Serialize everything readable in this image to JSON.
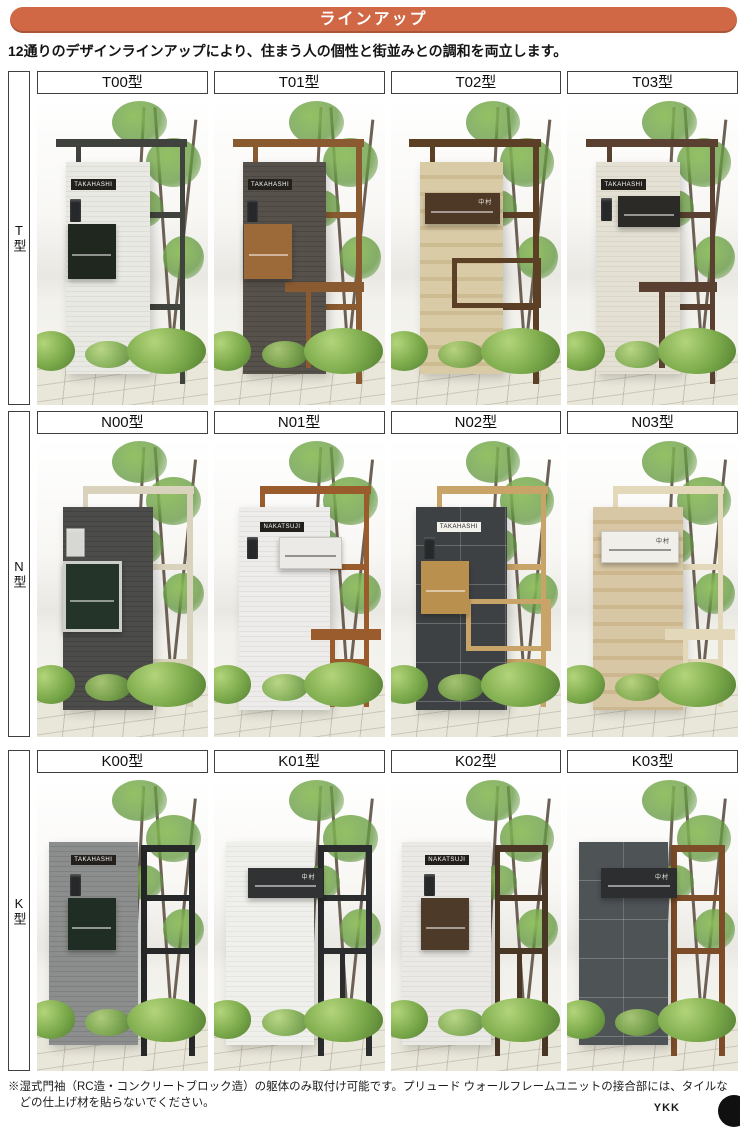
{
  "banner": {
    "label": "ラインアップ",
    "bg": "#d06845"
  },
  "intro": "12通りのデザインラインアップにより、住まう人の個性と街並みとの調和を両立します。",
  "rows": [
    {
      "side_label": "T型",
      "cells": [
        {
          "label": "T00型",
          "name": "TAKAHASHI",
          "colors": {
            "wall": "#e9e9e4",
            "wall2": "#dddcd5",
            "frame": "#3f423d",
            "mail": "#20271f"
          }
        },
        {
          "label": "T01型",
          "name": "TAKAHASHI",
          "colors": {
            "wall": "#57514b",
            "wall2": "#4b463f",
            "frame": "#8a5a31",
            "mail": "#9c6a38"
          }
        },
        {
          "label": "T02型",
          "name": "中村",
          "colors": {
            "wall": "#d9cba6",
            "wall2": "#cdbb92",
            "frame": "#5c4026",
            "mail": "#4e3826"
          }
        },
        {
          "label": "T03型",
          "name": "TAKAHASHI",
          "colors": {
            "wall": "#e4e1d4",
            "wall2": "#d9d6c7",
            "frame": "#5a4030",
            "mail": "#2c2a26"
          }
        }
      ]
    },
    {
      "side_label": "N型",
      "cells": [
        {
          "label": "N00型",
          "name": "",
          "colors": {
            "wall": "#4c4d4b",
            "wall2": "#424341",
            "frame": "#d9d3bd",
            "mail": "#243428"
          }
        },
        {
          "label": "N01型",
          "name": "NAKATSUJI",
          "colors": {
            "wall": "#edecea",
            "wall2": "#e1e0dd",
            "frame": "#9a5c2c",
            "mail": "#eceae6"
          }
        },
        {
          "label": "N02型",
          "name": "TAKAHASHI",
          "colors": {
            "wall": "#3e4143",
            "wall2": "#35383a",
            "frame": "#c9a469",
            "mail": "#b9904e"
          }
        },
        {
          "label": "N03型",
          "name": "中村",
          "colors": {
            "wall": "#d8c7a4",
            "wall2": "#ccb78e",
            "frame": "#e3d9ba",
            "mail": "#f0efe9"
          }
        }
      ]
    },
    {
      "side_label": "K型",
      "cells": [
        {
          "label": "K00型",
          "name": "TAKAHASHI",
          "colors": {
            "wall": "#8b8e8c",
            "wall2": "#7e817f",
            "frame": "#26282a",
            "mail": "#202d25"
          }
        },
        {
          "label": "K01型",
          "name": "中村",
          "colors": {
            "wall": "#efefeb",
            "wall2": "#e5e5e0",
            "frame": "#2a2c2e",
            "mail": "#303234"
          }
        },
        {
          "label": "K02型",
          "name": "NAKATSUJI",
          "colors": {
            "wall": "#eae9e5",
            "wall2": "#dfdeda",
            "frame": "#4a3624",
            "mail": "#4d3a28"
          }
        },
        {
          "label": "K03型",
          "name": "中村",
          "colors": {
            "wall": "#4e5356",
            "wall2": "#43474a",
            "frame": "#7c4d28",
            "mail": "#2c2e30"
          }
        }
      ]
    }
  ],
  "footnote": "※湿式門袖（RC造・コンクリートブロック造）の躯体のみ取付け可能です。プリュード ウォールフレームユニットの接合部には、タイルなどの仕上げ材を貼らないでください。",
  "logo": "YKK"
}
